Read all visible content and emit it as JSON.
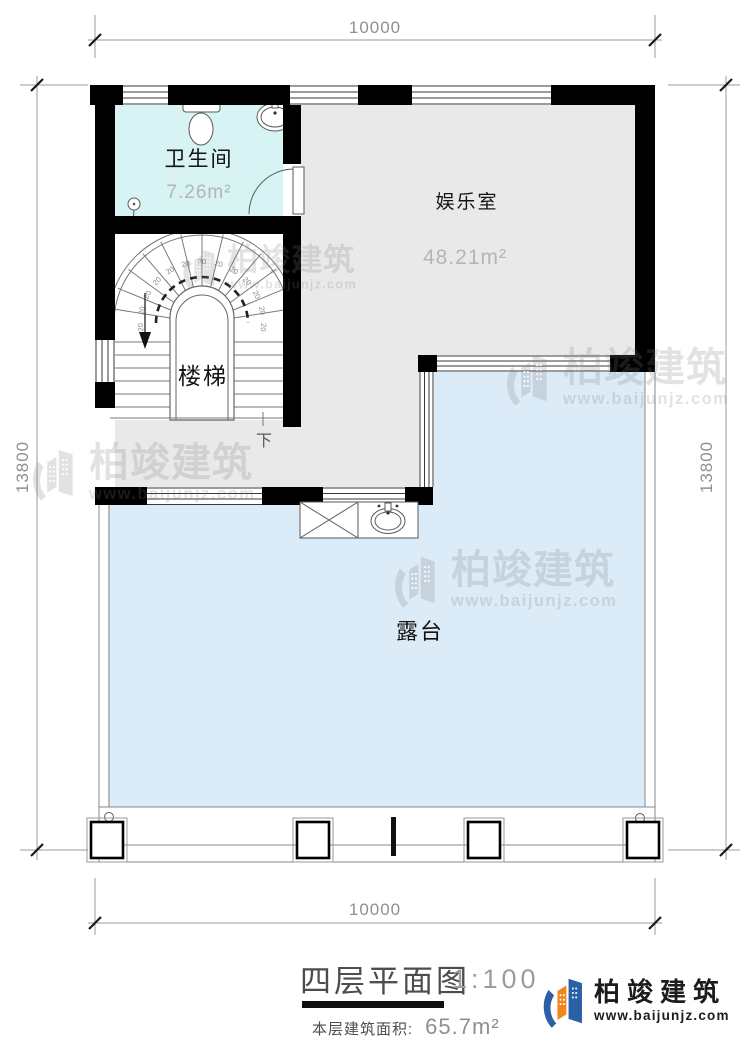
{
  "drawing": {
    "title": "四层平面图",
    "scale_label": "1:100",
    "floor_area_label": "本层建筑面积:",
    "floor_area_value": "65.7m²",
    "dimensions": {
      "top": "10000",
      "bottom": "10000",
      "left": "13800",
      "right": "13800"
    },
    "rooms": {
      "bathroom": {
        "name": "卫生间",
        "area": "7.26m²"
      },
      "entertainment": {
        "name": "娱乐室",
        "area": "48.21m²"
      },
      "stairs": {
        "name": "楼梯",
        "direction": "下",
        "tread_label": "20",
        "tread_count": 13
      },
      "terrace": {
        "name": "露台"
      }
    }
  },
  "watermark": {
    "name": "柏竣建筑",
    "url": "www.baijunjz.com"
  },
  "logo": {
    "name": "柏竣建筑",
    "url": "www.baijunjz.com"
  },
  "colors": {
    "bathroom_fill": "#d7f3f3",
    "room_fill": "#e9e9e9",
    "terrace_fill": "#dcebf8",
    "wall": "#000000",
    "logo_blue": "#2b5fa6",
    "logo_orange": "#f0861c"
  }
}
